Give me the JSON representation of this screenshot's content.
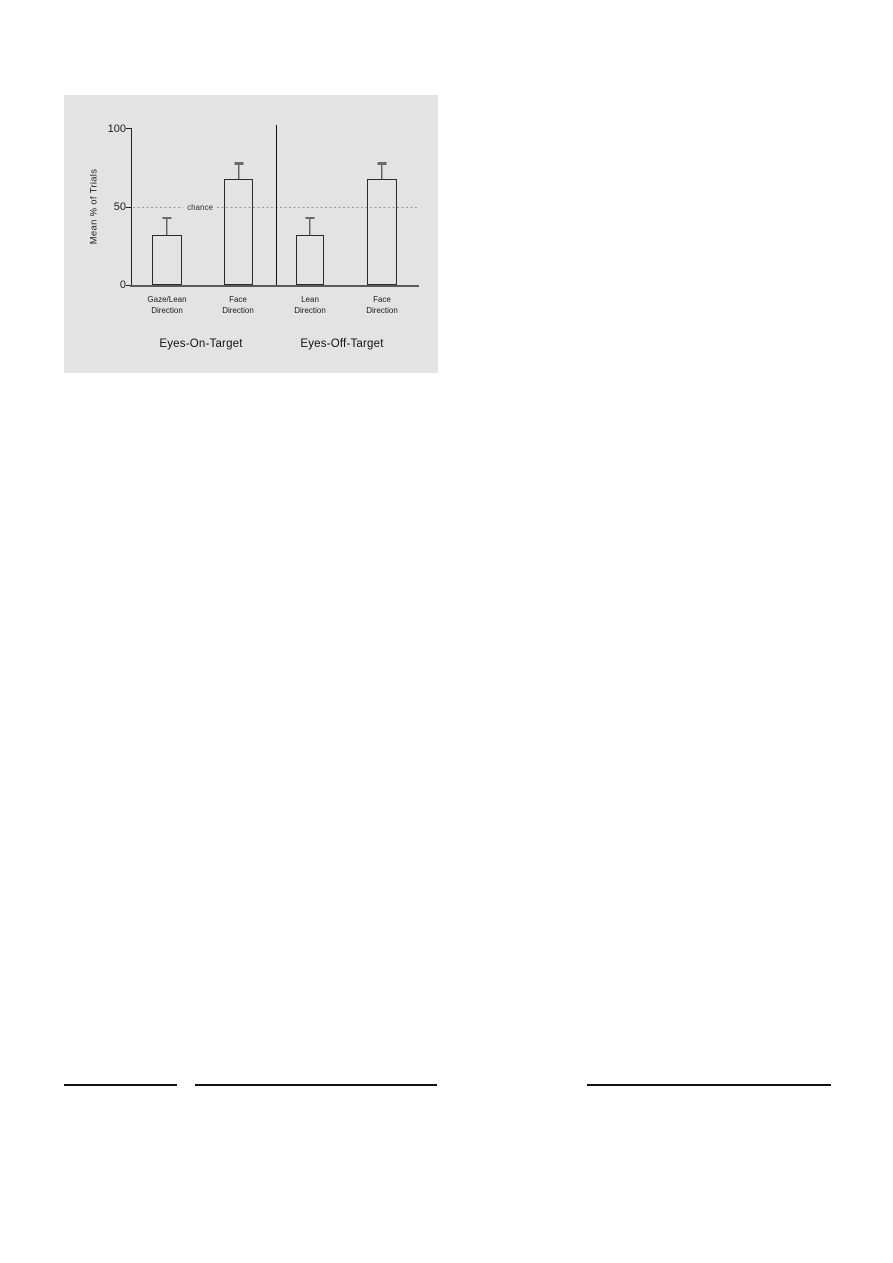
{
  "chart_data": {
    "type": "bar",
    "title": "",
    "xlabel": "",
    "ylabel": "Mean % of Trials",
    "ylim": [
      0,
      100
    ],
    "yticks": [
      0,
      50,
      100
    ],
    "grid": false,
    "legend": false,
    "error_bars": "upper-only",
    "reference_line": {
      "value": 50,
      "label": "chance",
      "style": "dashed"
    },
    "groups": [
      {
        "label": "Eyes-On-Target",
        "bars": [
          {
            "label_line1": "Gaze/Lean",
            "label_line2": "Direction",
            "value": 32,
            "error_upper": 11
          },
          {
            "label_line1": "Face",
            "label_line2": "Direction",
            "value": 68,
            "error_upper": 10
          }
        ]
      },
      {
        "label": "Eyes-Off-Target",
        "bars": [
          {
            "label_line1": "Lean",
            "label_line2": "Direction",
            "value": 32,
            "error_upper": 11
          },
          {
            "label_line1": "Face",
            "label_line2": "Direction",
            "value": 68,
            "error_upper": 10
          }
        ]
      }
    ],
    "colors": {
      "panel_background": "#e3e3e3",
      "bar_fill": "transparent",
      "bar_outline": "#2b2b2b",
      "axis": "#222222",
      "reference_line": "#9a9a9a",
      "text": "#1a1a1a"
    }
  }
}
